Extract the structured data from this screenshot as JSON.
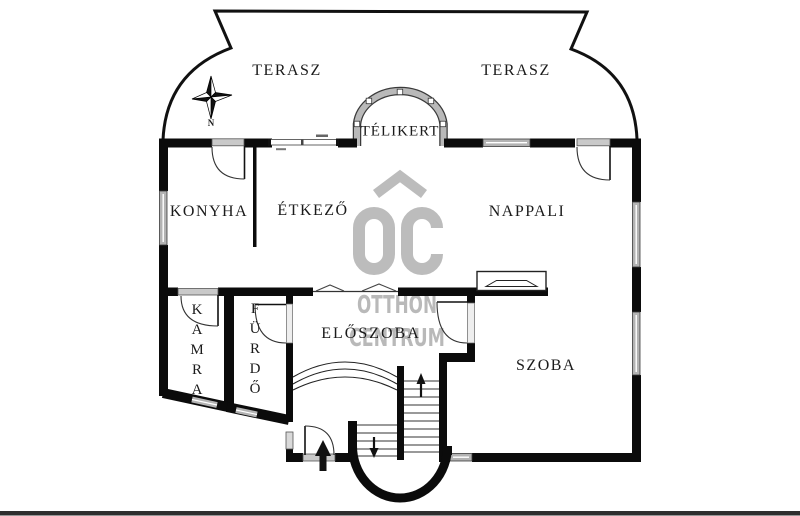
{
  "rooms": {
    "terasz_left": "TERASZ",
    "terasz_right": "TERASZ",
    "telikert": "TÉLIKERT",
    "konyha": "KONYHA",
    "etkezo": "ÉTKEZŐ",
    "nappali": "NAPPALI",
    "kamra": "K\nA\nM\nR\nA",
    "furdo": "F\nÜ\nR\nD\nŐ",
    "eloszoba": "ELŐSZOBA",
    "szoba": "SZOBA"
  },
  "compass": {
    "north": "N"
  },
  "watermark": {
    "logo_text": "OC",
    "line1": "OTTHON",
    "line2": "CENTRUM",
    "color": "#b9b9b9"
  },
  "colors": {
    "wall": "#0b0b0b",
    "window_fill": "#b3b3b3",
    "line": "#222222",
    "background": "#ffffff"
  }
}
